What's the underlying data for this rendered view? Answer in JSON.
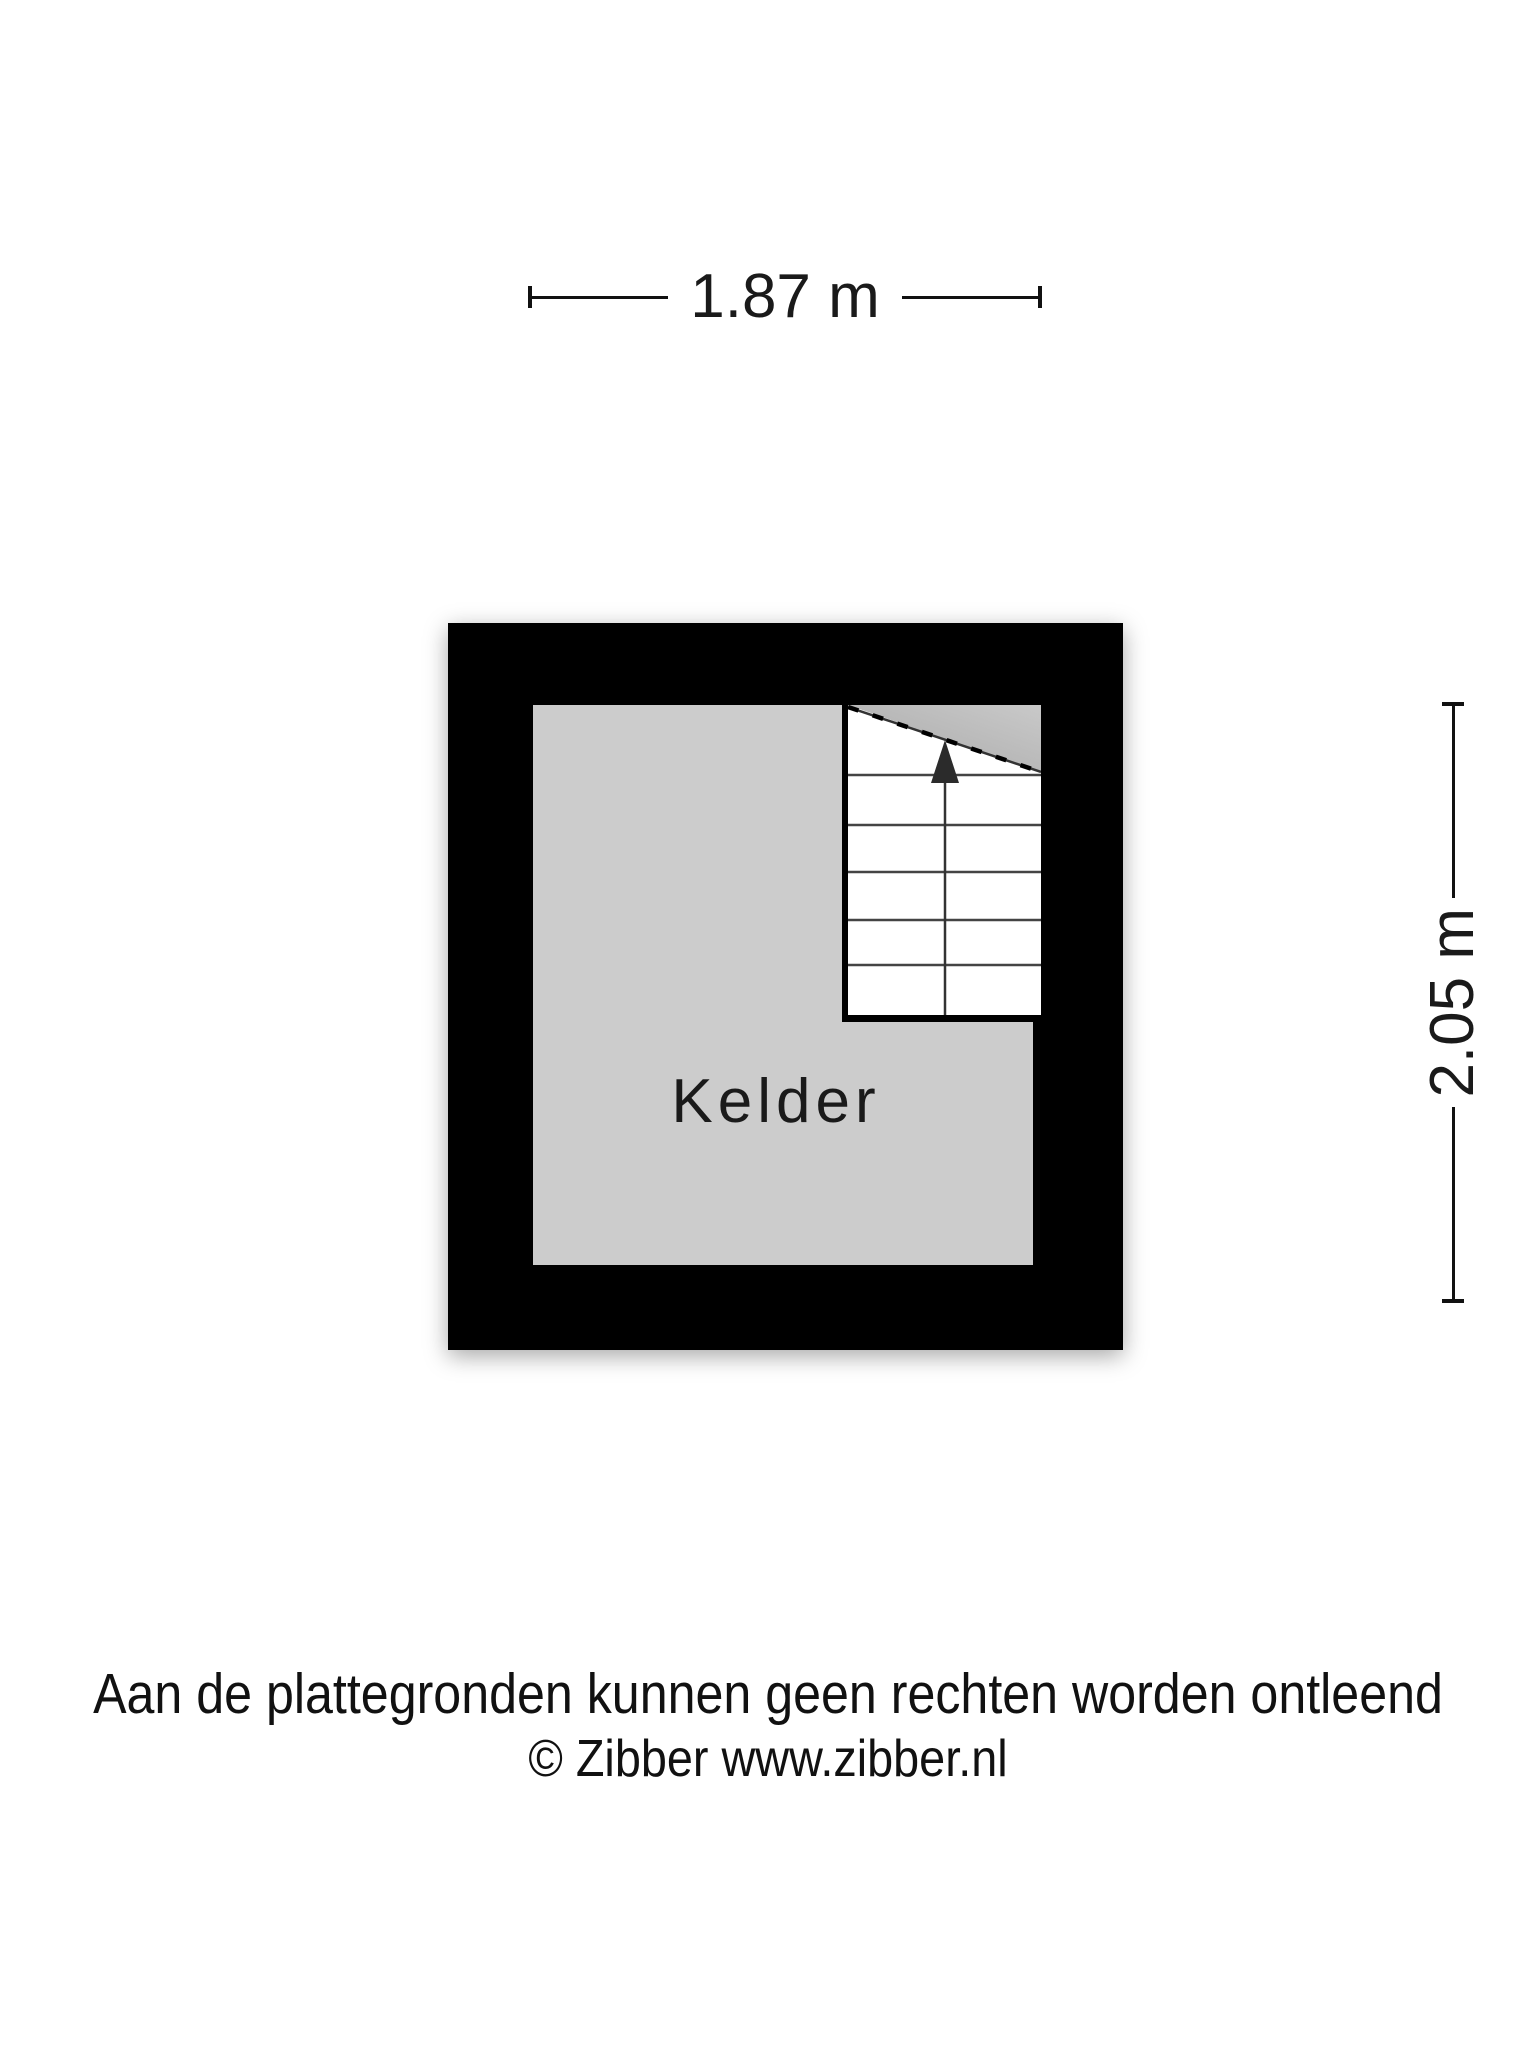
{
  "page": {
    "background_color": "#ffffff",
    "text_color": "#1a1a1a"
  },
  "dimensions": {
    "width_label": "1.87 m",
    "height_label": "2.05 m"
  },
  "floorplan": {
    "room_label": "Kelder",
    "wall_color": "#000000",
    "floor_color": "#cccccc",
    "stair_fill_color": "#ffffff",
    "stairs": {
      "direction": "up",
      "tread_count": 6,
      "arrow_icon": "stairs-up-arrow-icon"
    }
  },
  "footer": {
    "disclaimer": "Aan de plattegronden kunnen geen rechten worden ontleend",
    "copyright": "© Zibber www.zibber.nl"
  }
}
